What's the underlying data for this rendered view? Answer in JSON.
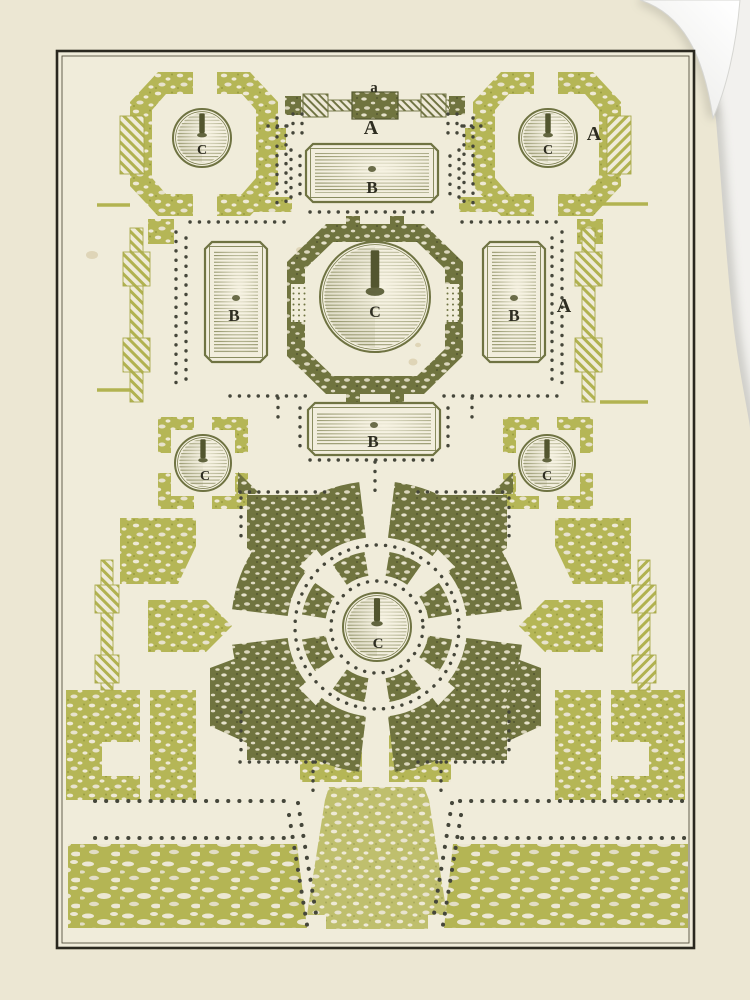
{
  "artwork": {
    "labels": {
      "gate_small": "a",
      "gate": "A",
      "corner_right": "A",
      "east_wall": "A",
      "basin_top": "B",
      "basin_west": "B",
      "basin_east": "B",
      "basin_south": "B",
      "fountain_northwest": "C",
      "fountain_northeast": "C",
      "fountain_center": "C",
      "fountain_west": "C",
      "fountain_east": "C",
      "fountain_south": "C"
    },
    "palette": {
      "paper": "#ece7d3",
      "plate": "#f0ecda",
      "chartreuse": "#b5b656",
      "olive": "#6f7342",
      "ink": "#2e2d21",
      "dot": "#45463a",
      "border": "#2a281f",
      "wall_background": "#f2f1ee",
      "curl_white": "#fdfdfd"
    }
  }
}
